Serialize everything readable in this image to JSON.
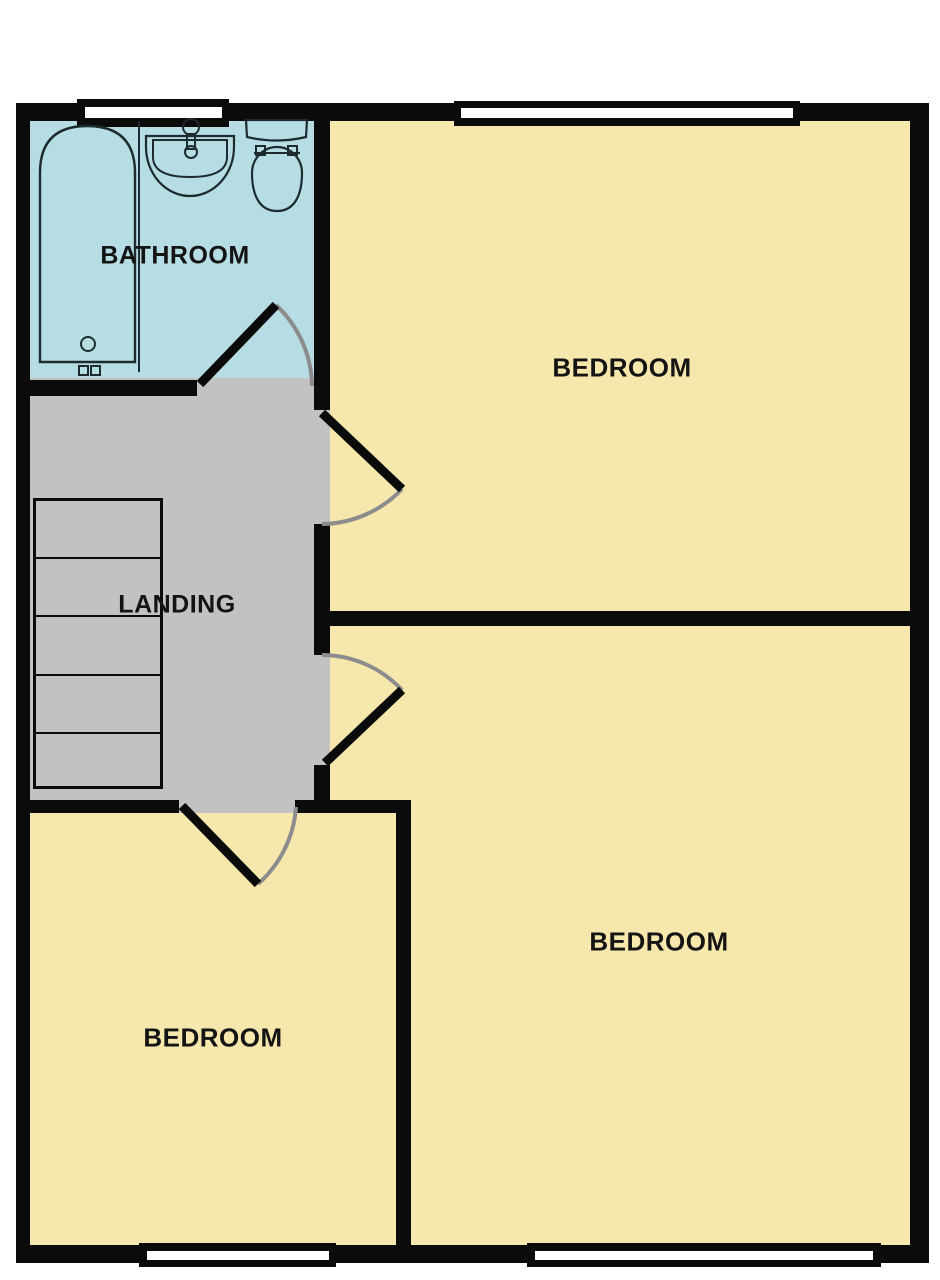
{
  "plan": {
    "type": "floorplan",
    "floor_rooms_count": 5
  },
  "rooms": [
    {
      "id": "bathroom",
      "label": "BATHROOM",
      "color": "#b5dde3"
    },
    {
      "id": "landing",
      "label": "LANDING",
      "color": "#c3c2c3"
    },
    {
      "id": "bedroom-top",
      "label": "BEDROOM",
      "color": "#f6e8ac"
    },
    {
      "id": "bedroom-bottom-right",
      "label": "BEDROOM",
      "color": "#f6e8ac"
    },
    {
      "id": "bedroom-bottom-left",
      "label": "BEDROOM",
      "color": "#f6e8ac"
    }
  ],
  "fixtures": [
    {
      "name": "bath"
    },
    {
      "name": "sink"
    },
    {
      "name": "toilet"
    },
    {
      "name": "staircase",
      "steps": 5
    }
  ],
  "openings": {
    "windows": 4,
    "doors": 4
  },
  "palette": {
    "wall": "#0b0b0b",
    "door_arc": "#8c8c8c",
    "window_glass": "#ffffff",
    "fixture_outline": "#1d2a2e",
    "background": "#ffffff"
  }
}
